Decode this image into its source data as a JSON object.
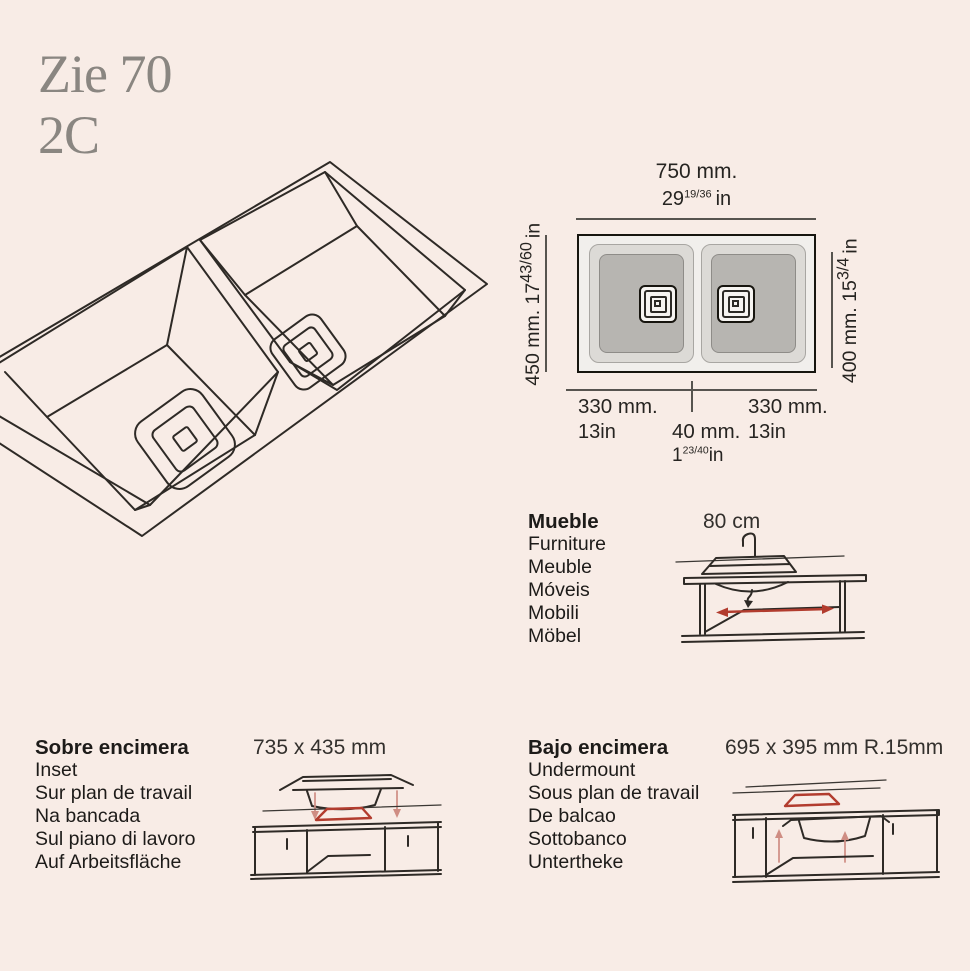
{
  "product": {
    "title_line1": "Zie 70",
    "title_line2": "2C"
  },
  "colors": {
    "background": "#f8ece6",
    "accent_red": "#b23c2e",
    "pale_red": "#cf8d83",
    "title_gray": "#8a8681"
  },
  "top_view": {
    "width_mm": "750 mm.",
    "width_in_whole": "29",
    "width_in_frac": "19/36",
    "width_in_unit": "in",
    "depth_left_mm": "450 mm. ",
    "depth_left_whole": "17",
    "depth_left_frac": "43/60",
    "depth_left_unit": "in",
    "depth_right_mm": "400 mm. ",
    "depth_right_whole": "15",
    "depth_right_frac": "3/4",
    "depth_right_unit": "in",
    "bowl_left_mm": "330 mm.",
    "bowl_left_in": "13in",
    "divider_mm": "40 mm.",
    "divider_in_whole": "1",
    "divider_in_frac": "23/40",
    "divider_in_unit": "in",
    "bowl_right_mm": "330 mm.",
    "bowl_right_in": "13in"
  },
  "furniture": {
    "labels": [
      "Mueble",
      "Furniture",
      "Meuble",
      "Móveis",
      "Mobili",
      "Möbel"
    ],
    "value": "80 cm"
  },
  "inset": {
    "labels": [
      "Sobre encimera",
      "Inset",
      "Sur plan de travail",
      "Na bancada",
      "Sul piano di lavoro",
      "Auf Arbeitsfläche"
    ],
    "value": "735 x 435 mm"
  },
  "undermount": {
    "labels": [
      "Bajo encimera",
      "Undermount",
      "Sous plan de travail",
      "De balcao",
      "Sottobanco",
      "Untertheke"
    ],
    "value": "695 x 395 mm R.15mm"
  }
}
